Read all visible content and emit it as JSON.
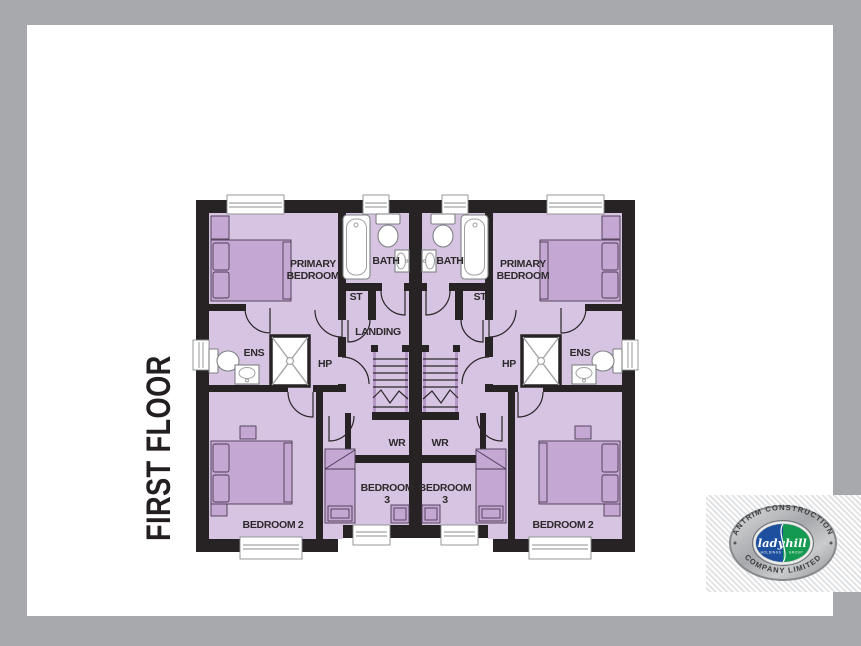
{
  "title": {
    "text": "FIRST FLOOR"
  },
  "plan": {
    "labels": {
      "primary_line1": "PRIMARY",
      "primary_line2": "BEDROOM",
      "bath": "BATH",
      "st": "ST",
      "landing": "LANDING",
      "ens": "ENS",
      "hp": "HP",
      "wr": "WR",
      "bedroom3_line1": "BEDROOM",
      "bedroom3_line2": "3",
      "bedroom2": "BEDROOM 2"
    },
    "colors": {
      "wall": "#272324",
      "room_fill": "#d6c4e2",
      "furniture_fill": "#c5a7d3",
      "fixture_white": "#ffffff",
      "label_text": "#2d2a2b"
    }
  },
  "logo": {
    "arc_top": "ANTRIM CONSTRUCTION",
    "arc_bottom": "COMPANY LIMITED",
    "script_left": "lady",
    "script_left_sub": "HOLDINGS",
    "script_right": "hill",
    "script_right_sub": "GROUP",
    "colors": {
      "blue": "#1d4f9e",
      "green": "#149a50",
      "silver": "#b9bbbe"
    }
  },
  "canvas": {
    "background": "#a7a9ac",
    "page": "#ffffff"
  }
}
